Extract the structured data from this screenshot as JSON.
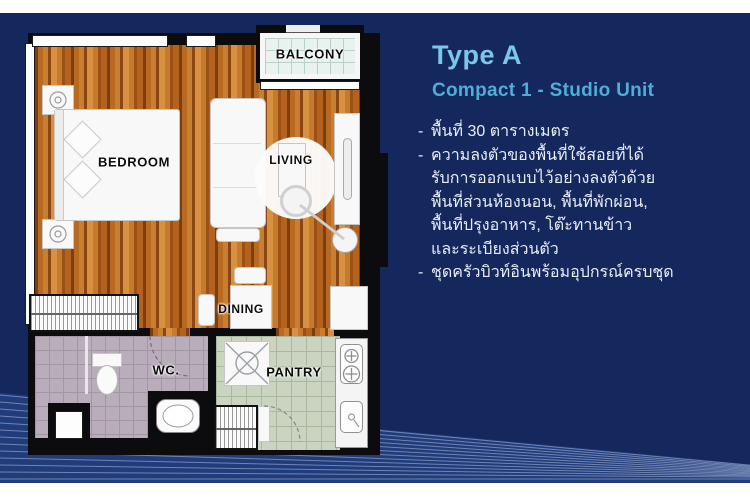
{
  "panel": {
    "title": "Type A",
    "subtitle": "Compact 1 - Studio Unit",
    "bullets": [
      {
        "dash": "-",
        "text": "พื้นที่ 30 ตารางเมตร"
      },
      {
        "dash": "-",
        "text": "ความลงตัวของพื้นที่ใช้สอยที่ได้"
      },
      {
        "dash": "",
        "text": "รับการออกแบบไว้อย่างลงตัวด้วย"
      },
      {
        "dash": "",
        "text": "พื้นที่ส่วนห้องนอน, พื้นที่พักผ่อน,"
      },
      {
        "dash": "",
        "text": "พื้นที่ปรุงอาหาร, โต๊ะทานข้าว"
      },
      {
        "dash": "",
        "text": "และระเบียงส่วนตัว"
      },
      {
        "dash": "-",
        "text": "ชุดครัวบิวท์อินพร้อมอุปกรณ์ครบชุด"
      }
    ]
  },
  "floorplan": {
    "rooms": {
      "bedroom": "BEDROOM",
      "living": "LIVING",
      "balcony": "BALCONY",
      "dining": "DINING",
      "wc": "WC.",
      "pantry": "PANTRY"
    }
  },
  "colors": {
    "background_navy": "#15285e",
    "title_blue": "#7cc6e9",
    "subtitle_blue": "#4fadd6",
    "body_text": "#e9eef7",
    "wall_black": "#0c0c0e",
    "wood_floor": "#b96a22",
    "balcony_tile": "#e9f2ee",
    "wc_tile": "#b9adbb",
    "pantry_tile": "#cad4c0",
    "stripe_line": "#a5b4d7"
  }
}
